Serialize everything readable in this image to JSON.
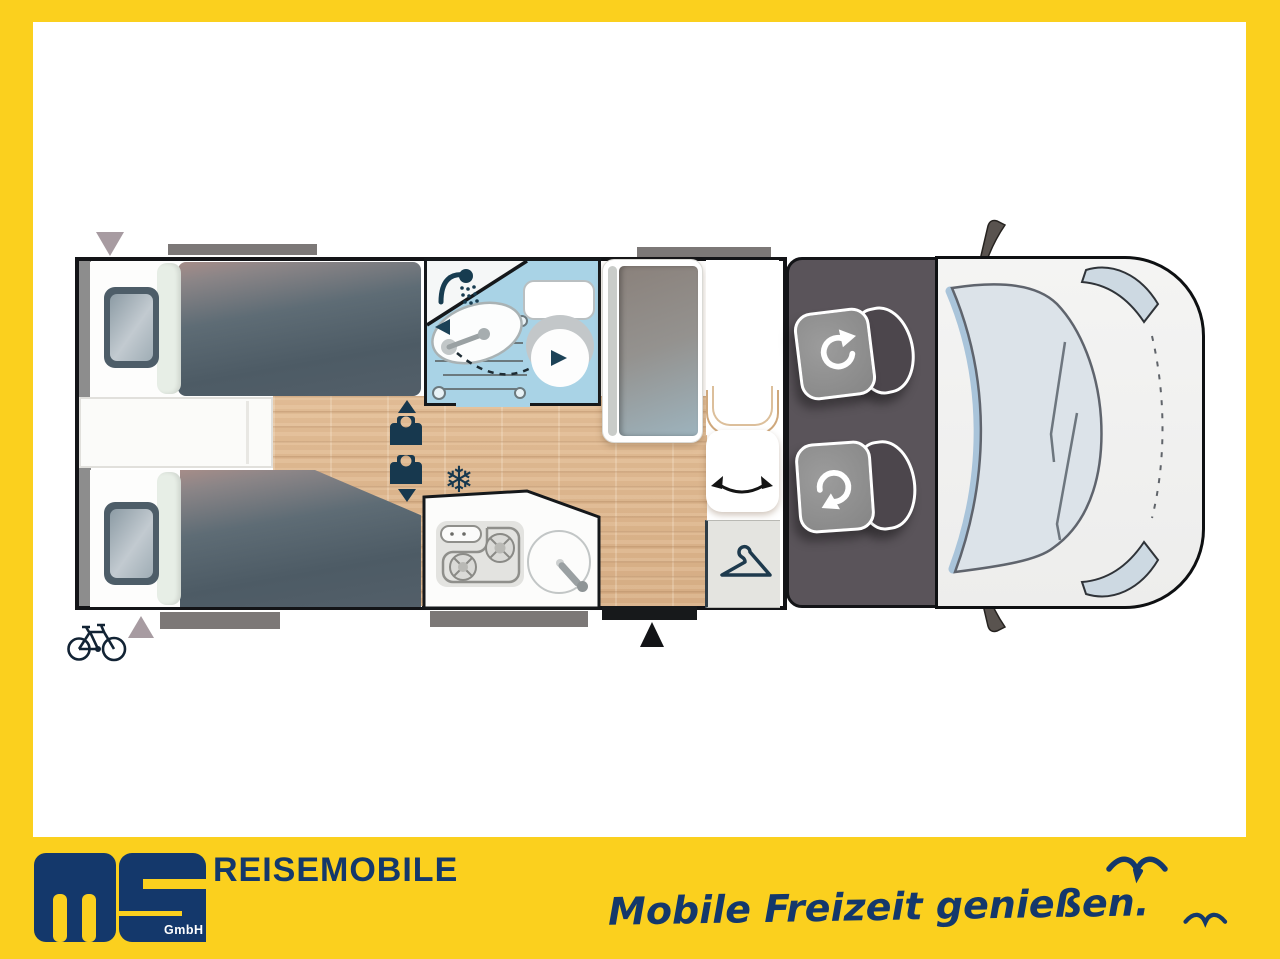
{
  "frame": {
    "accent_yellow": "#fbd01e"
  },
  "brand": {
    "logo_text": "MS",
    "legal_suffix": "GmbH",
    "company": "REISEMOBILE",
    "slogan": "Mobile Freizeit genießen.",
    "navy": "#14386b"
  },
  "floorplan": {
    "type": "motorhome-top-view",
    "zones": [
      "twin-single-beds-rear",
      "bathroom-with-shower-sink-toilet",
      "refrigerator-cabinet",
      "kitchen-with-stove-and-sink",
      "wardrobe",
      "entry-door",
      "cab-with-two-swivel-seats",
      "vehicle-front"
    ],
    "icons": {
      "snowflake_glyph": "❄",
      "names": [
        "shower-icon",
        "snowflake-icon",
        "travel-seat-icon",
        "seat-rotation-arrow-icon",
        "door-swivel-arrows-icon",
        "hanger-icon",
        "bicycle-icon",
        "entry-arrow-icon",
        "rear-door-arrow-icon"
      ]
    },
    "colors": {
      "bathroom_blue": "#a9d3e6",
      "mattress_slate": "#4d5b65",
      "wood_floor": "#dcb48d",
      "cab_floor": "#5a545a",
      "icon_navy": "#17384e"
    }
  }
}
